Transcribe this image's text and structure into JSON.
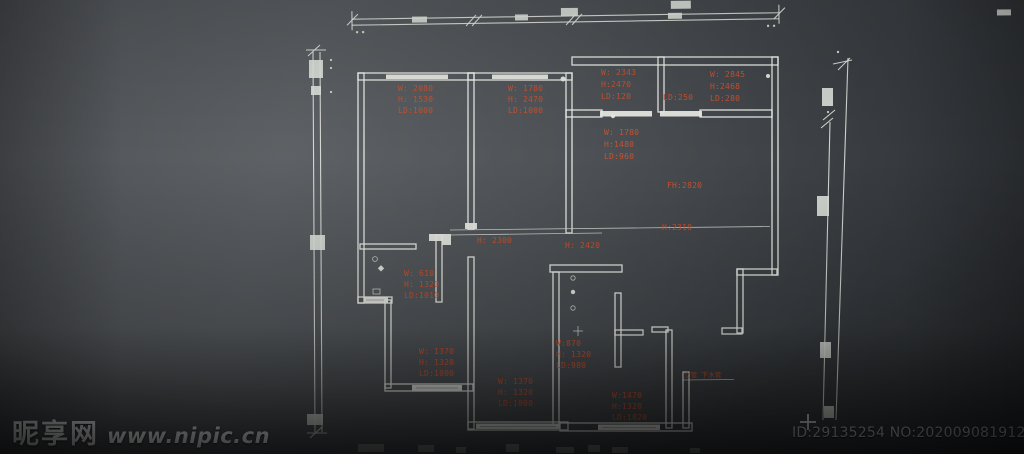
{
  "colors": {
    "annotation": "#cd5330",
    "line": "#edefe9",
    "background": "#45484c"
  },
  "watermark": {
    "site_name": "昵享网",
    "site_url": "www.nipic.cn"
  },
  "footer": {
    "id_label": "ID:29135254 NO:20200908191236177754"
  },
  "plan": {
    "window_labels": [
      {
        "w": "W: 2080",
        "h": "H: 1530",
        "ld": "LD:1000"
      },
      {
        "w": "W: 1780",
        "h": "H: 2470",
        "ld": "LD:1000"
      },
      {
        "w": "W: 2343",
        "h": "H:2470",
        "ld": "LD:120"
      },
      {
        "w": "W: 2845",
        "h": "H:2468",
        "ld": "LD:280"
      },
      {
        "w": "W: 1780",
        "h": "H:1480",
        "ld": "LD:960"
      },
      {
        "w": "W: 610",
        "h": "H: 1320",
        "ld": "LD:1010"
      },
      {
        "w": "W: 1370",
        "h": "H: 1320",
        "ld": "LD:1000"
      },
      {
        "w": "W: 1370",
        "h": "H: 1320",
        "ld": "LD:1000"
      },
      {
        "w": "W:870",
        "h": "H: 1320",
        "ld": "LD:980"
      },
      {
        "w": "W:1470",
        "h": "H:1320",
        "ld": "LD:1020"
      }
    ],
    "dim_labels": {
      "door_height": "H: 2300",
      "corridor_height": "H: 2420",
      "beam_height": "H:2310",
      "floor_height": "FH:2820",
      "sill": "LD:250"
    },
    "pipe_note": "立管 下水管"
  }
}
